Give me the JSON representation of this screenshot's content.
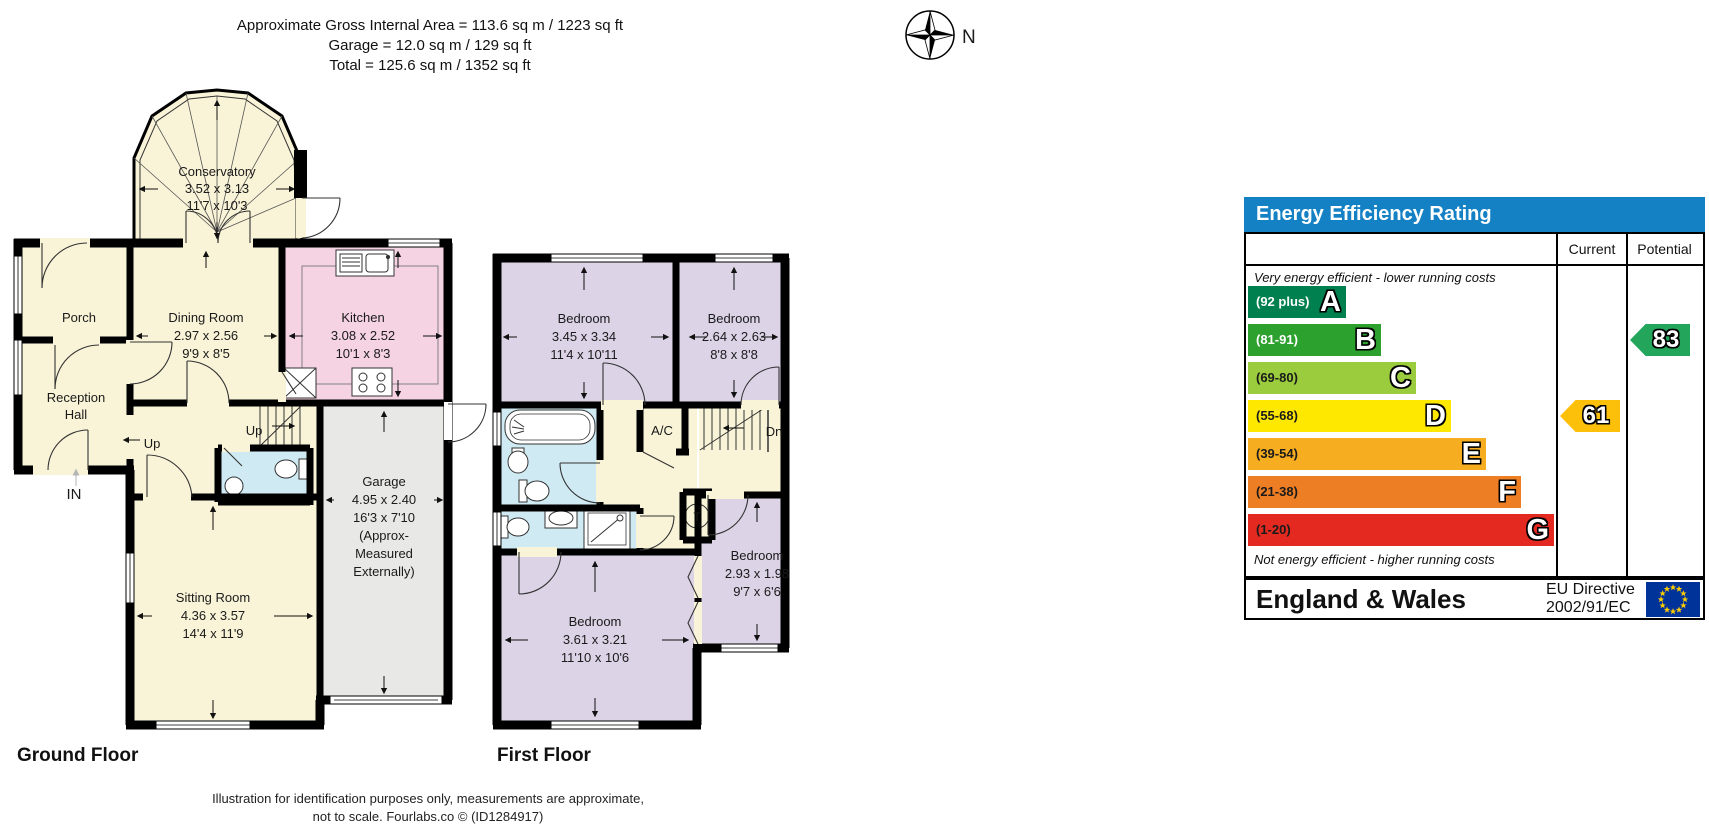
{
  "header_area": {
    "line1": "Approximate Gross Internal Area = 113.6 sq m / 1223 sq ft",
    "line2": "Garage = 12.0 sq m / 129 sq ft",
    "line3": "Total = 125.6 sq m / 1352 sq ft"
  },
  "compass": {
    "north_label": "N"
  },
  "ground_floor": {
    "label": "Ground Floor",
    "rooms": {
      "conservatory": {
        "name": "Conservatory",
        "metric": "3.52 x 3.13",
        "imperial": "11'7 x 10'3"
      },
      "porch": {
        "name": "Porch"
      },
      "reception_hall": {
        "name1": "Reception",
        "name2": "Hall"
      },
      "dining": {
        "name": "Dining Room",
        "metric": "2.97 x 2.56",
        "imperial": "9'9 x 8'5"
      },
      "kitchen": {
        "name": "Kitchen",
        "metric": "3.08 x 2.52",
        "imperial": "10'1 x 8'3"
      },
      "sitting": {
        "name": "Sitting Room",
        "metric": "4.36 x 3.57",
        "imperial": "14'4 x 11'9"
      },
      "garage": {
        "name": "Garage",
        "metric": "4.95 x 2.40",
        "imperial": "16'3 x 7'10",
        "note1": "(Approx-",
        "note2": "Measured",
        "note3": "Externally)"
      }
    },
    "annotations": {
      "up1": "Up",
      "up2": "Up",
      "entrance": "IN"
    }
  },
  "first_floor": {
    "label": "First Floor",
    "rooms": {
      "bedroom1": {
        "name": "Bedroom",
        "metric": "3.45 x 3.34",
        "imperial": "11'4 x 10'11"
      },
      "bedroom2": {
        "name": "Bedroom",
        "metric": "2.64 x 2.63",
        "imperial": "8'8 x 8'8"
      },
      "bedroom3": {
        "name": "Bedroom",
        "metric": "3.61 x 3.21",
        "imperial": "11'10 x 10'6"
      },
      "bedroom4": {
        "name": "Bedroom",
        "metric": "2.93 x 1.98",
        "imperial": "9'7 x 6'6"
      }
    },
    "annotations": {
      "airing_cupboard": "A/C",
      "down": "Dn",
      "tank": "T"
    }
  },
  "epc": {
    "title": "Energy Efficiency Rating",
    "columns": {
      "current": "Current",
      "potential": "Potential"
    },
    "top_note": "Very energy efficient - lower running costs",
    "bottom_note": "Not energy efficient - higher running costs",
    "bands": [
      {
        "letter": "A",
        "range": "(92 plus)",
        "color": "#00804e"
      },
      {
        "letter": "B",
        "range": "(81-91)",
        "color": "#2da12e"
      },
      {
        "letter": "C",
        "range": "(69-80)",
        "color": "#9bcc3d"
      },
      {
        "letter": "D",
        "range": "(55-68)",
        "color": "#ffe800"
      },
      {
        "letter": "E",
        "range": "(39-54)",
        "color": "#f6ad20"
      },
      {
        "letter": "F",
        "range": "(21-38)",
        "color": "#ee7e24"
      },
      {
        "letter": "G",
        "range": "(1-20)",
        "color": "#e42a20"
      }
    ],
    "current": {
      "value": "61",
      "band": "D",
      "color": "#fcbf0a"
    },
    "potential": {
      "value": "83",
      "band": "B",
      "color": "#23a65b"
    },
    "footer": {
      "region": "England & Wales",
      "directive_line1": "EU Directive",
      "directive_line2": "2002/91/EC"
    }
  },
  "disclaimer": {
    "line1": "Illustration for identification purposes only, measurements are approximate,",
    "line2": "not to scale. Fourlabs.co © (ID1284917)"
  },
  "chart_data": {
    "type": "bar",
    "title": "Energy Efficiency Rating",
    "categories": [
      "A",
      "B",
      "C",
      "D",
      "E",
      "F",
      "G"
    ],
    "band_ranges": [
      "92 plus",
      "81-91",
      "69-80",
      "55-68",
      "39-54",
      "21-38",
      "1-20"
    ],
    "values": [
      98,
      133,
      168,
      203,
      238,
      273,
      306
    ],
    "markers": {
      "current": 61,
      "potential": 83
    },
    "notes": [
      "Very energy efficient - lower running costs",
      "Not energy efficient - higher running costs"
    ],
    "legend_position": "right-columns",
    "region_label": "England & Wales"
  }
}
